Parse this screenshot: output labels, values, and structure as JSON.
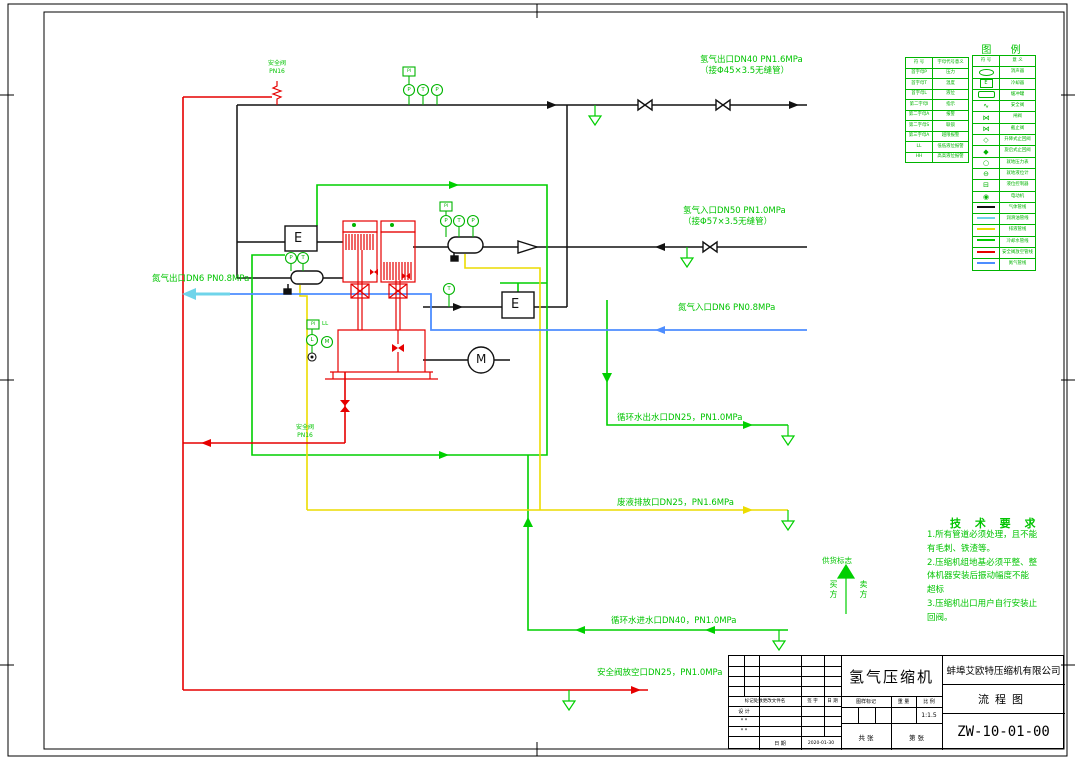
{
  "doc": {
    "title": "氢气压缩机",
    "company": "蚌埠艾欧特压缩机有限公司",
    "doc_type": "流程图",
    "drawing_no": "ZW-10-01-00",
    "scale": "1:1.5",
    "date": "2020-01-30",
    "rev_header_1": "标记处数更改文件名",
    "rev_header_2": "签 字",
    "rev_header_3": "日 期",
    "row_design": "设 计",
    "row_star1": "* *",
    "row_star2": "* *",
    "date_label": "日 期",
    "mark_label": "图样标记",
    "weight_label": "重 量",
    "scale_label": "比 例",
    "sheets_total": "共  张",
    "sheet_no": "第  张"
  },
  "legend": {
    "title": "图  例",
    "codes_header": [
      "符 号",
      "字母代号意义"
    ],
    "codes": [
      [
        "首字母P",
        "压力"
      ],
      [
        "首字母T",
        "温度"
      ],
      [
        "首字母L",
        "液位"
      ],
      [
        "第二字母I",
        "指示"
      ],
      [
        "第二字母A",
        "报警"
      ],
      [
        "第二字母S",
        "联锁"
      ],
      [
        "第三字母A",
        "越限报警"
      ],
      [
        "LL",
        "低低液位报警"
      ],
      [
        "HH",
        "高高液位报警"
      ]
    ],
    "symbols_header": [
      "符 号",
      "意 义"
    ],
    "symbols": [
      {
        "sym": "oval",
        "meaning": "消声器"
      },
      {
        "sym": "ebox",
        "meaning": "冷却器"
      },
      {
        "sym": "rrect",
        "meaning": "缓冲罐"
      },
      {
        "sym": "safety",
        "meaning": "安全阀"
      },
      {
        "sym": "gate",
        "meaning": "闸阀"
      },
      {
        "sym": "globe",
        "meaning": "截止阀"
      },
      {
        "sym": "check1",
        "meaning": "升降式止回阀"
      },
      {
        "sym": "check2",
        "meaning": "旋启式止回阀"
      },
      {
        "sym": "gauge",
        "meaning": "就地压力表"
      },
      {
        "sym": "levelglass",
        "meaning": "就地液位计"
      },
      {
        "sym": "levelbox",
        "meaning": "液位控制器"
      },
      {
        "sym": "motor",
        "meaning": "电动机"
      },
      {
        "sym": "line_black",
        "meaning": "气体管线"
      },
      {
        "sym": "line_cyan",
        "meaning": "润滑油管线"
      },
      {
        "sym": "line_yellow",
        "meaning": "排液管线"
      },
      {
        "sym": "line_green",
        "meaning": "冷却水管线"
      },
      {
        "sym": "line_red",
        "meaning": "安全阀放空管线"
      },
      {
        "sym": "line_blue",
        "meaning": "氮气管线"
      }
    ]
  },
  "tech": {
    "title": "技 术 要 求",
    "lines": [
      "1.所有管道必须处理，且不能",
      "有毛刺、铁渣等。",
      "2.压缩机组地基必须平整、整",
      "体机器安装后振动幅度不能",
      "超标",
      "3.压缩机出口用户自行安装止",
      "回阀。"
    ]
  },
  "pipe_labels": {
    "h2_out_1": "氢气出口DN40 PN1.6MPa",
    "h2_out_2": "（接Φ45×3.5无缝管）",
    "h2_in_1": "氢气入口DN50 PN1.0MPa",
    "h2_in_2": "（接Φ57×3.5无缝管）",
    "n2_out": "氮气出口DN6 PN0.8MPa",
    "n2_in": "氮气入口DN6 PN0.8MPa",
    "cw_out": "循环水出水口DN25，PN1.0MPa",
    "waste": "废液排放口DN25，PN1.6MPa",
    "cw_in": "循环水进水口DN40，PN1.0MPa",
    "relief": "安全阀放空口DN25，PN1.0MPa",
    "sv1_1": "安全阀",
    "sv1_2": "PN16",
    "sv2_1": "安全阀",
    "sv2_2": "PN16",
    "supply_mark": "供货标志",
    "buyer": "买方",
    "seller": "卖方"
  },
  "instruments": {
    "p": "P",
    "t": "T",
    "l": "L",
    "m": "M",
    "ll": "LL",
    "pi": "PI",
    "e": "E"
  },
  "colors": {
    "gas": "#111111",
    "lube_oil": "#6fd4ea",
    "drain": "#ecdc00",
    "cooling_water": "#00cf00",
    "relief": "#e60000",
    "nitrogen": "#4d8dff",
    "accent_green": "#00c400"
  }
}
